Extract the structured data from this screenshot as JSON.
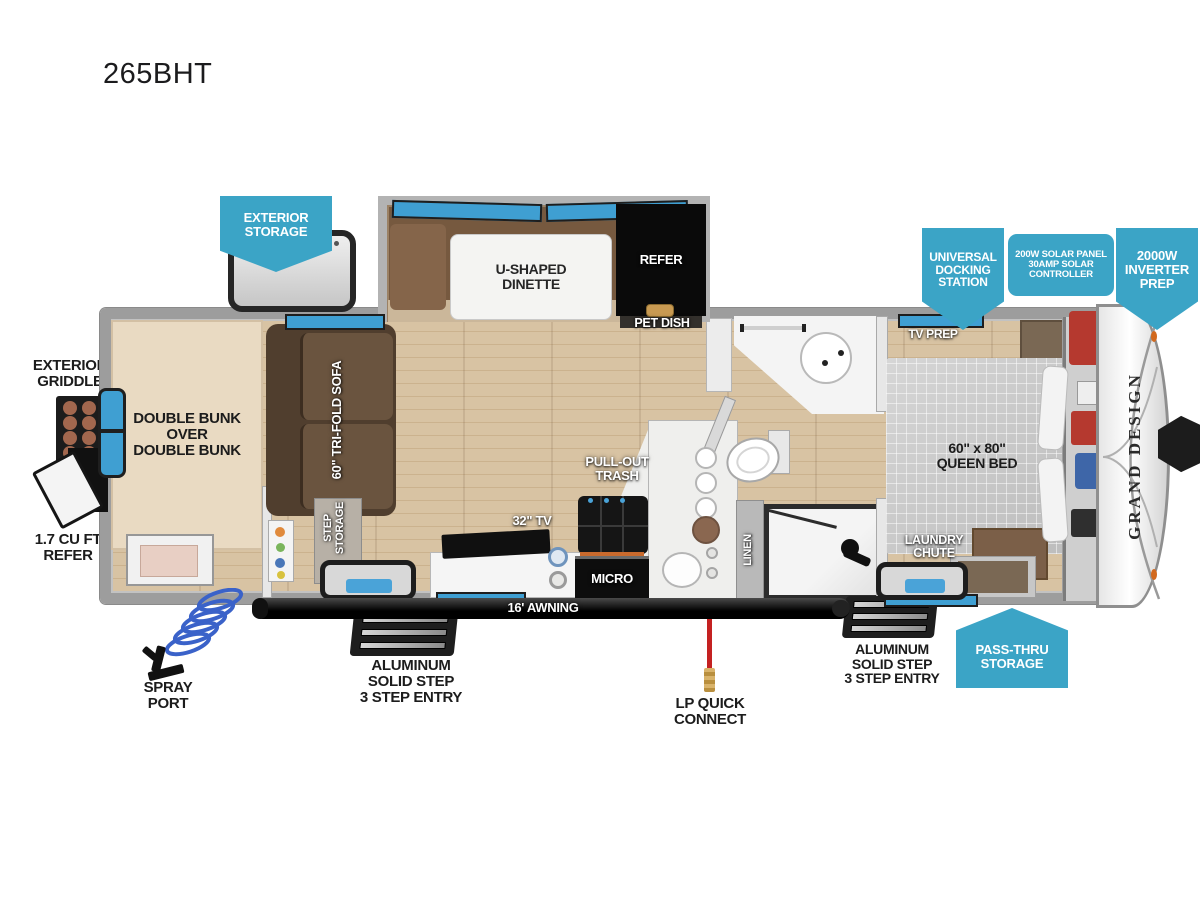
{
  "title": "265BHT",
  "brand": "GRAND DESIGN",
  "callouts": {
    "exterior_storage": "EXTERIOR\nSTORAGE",
    "universal_docking": "UNIVERSAL\nDOCKING\nSTATION",
    "solar": "200W SOLAR PANEL\n30AMP SOLAR\nCONTROLLER",
    "inverter": "2000W\nINVERTER\nPREP",
    "pass_thru": "PASS-THRU\nSTORAGE"
  },
  "exterior": {
    "griddle": "EXTERIOR\nGRIDDLE",
    "mini_refer": "1.7 CU FT\nREFER",
    "spray_port": "SPRAY\nPORT",
    "step_left": "ALUMINUM\nSOLID STEP\n3 STEP ENTRY",
    "lp": "LP QUICK\nCONNECT",
    "step_right": "ALUMINUM\nSOLID STEP\n3 STEP ENTRY",
    "awning": "16' AWNING"
  },
  "interior": {
    "dinette": "U-SHAPED\nDINETTE",
    "refer": "REFER",
    "pet_dish": "PET DISH",
    "bunks": "DOUBLE BUNK\nOVER\nDOUBLE BUNK",
    "sofa": "60\" TRI-FOLD SOFA",
    "step_storage": "STEP\nSTORAGE",
    "tv": "32\" TV",
    "trash": "PULL-OUT\nTRASH",
    "micro": "MICRO",
    "linen": "LINEN",
    "tv_prep": "TV PREP",
    "queen": "60\" x 80\"\nQUEEN BED",
    "laundry": "LAUNDRY\nCHUTE"
  },
  "colors": {
    "callout_blue": "#3ba4c6",
    "window_blue": "#3f9fd2",
    "wood": "#d2bc9c",
    "sofa_brown": "#54402f",
    "bunk_tan": "#e9dac2",
    "bed_gray": "#cbcbcb",
    "lp_red": "#c42121"
  }
}
